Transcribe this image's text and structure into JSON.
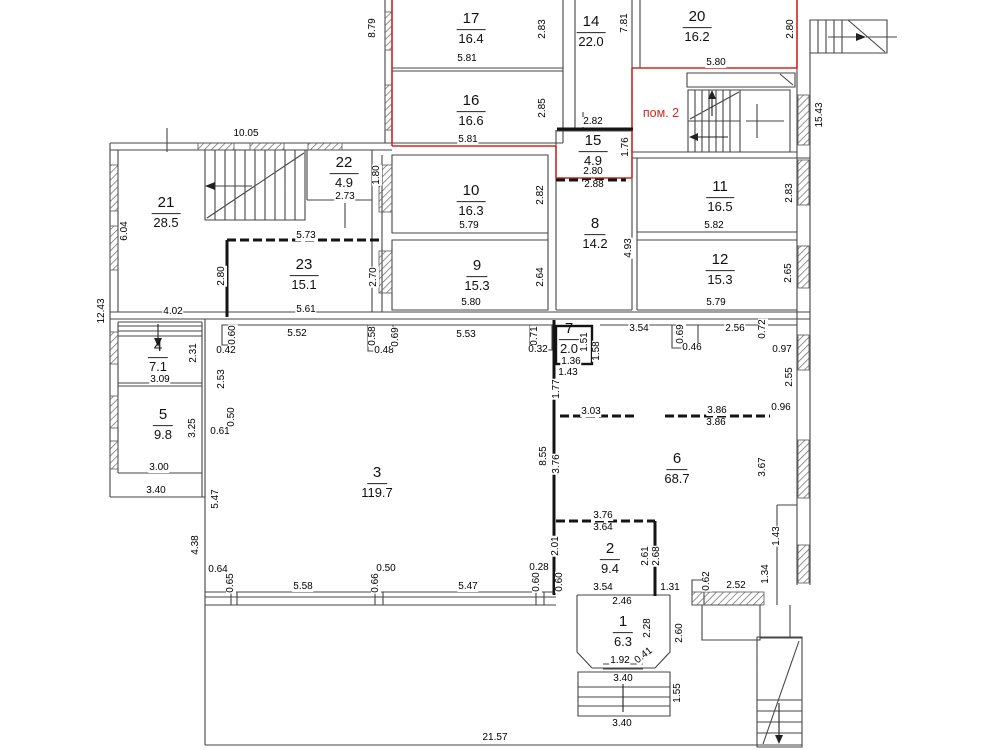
{
  "plan": {
    "unit_label": "пом. 2",
    "unit_label_color": "#d2281e",
    "unit_label_pos": {
      "x": 661,
      "y": 113
    },
    "wall_color": "#3f3f3f",
    "partition_color": "#141414",
    "background": "#ffffff"
  },
  "rooms": [
    {
      "number": "17",
      "area": "16.4",
      "x": 471,
      "y": 29
    },
    {
      "number": "16",
      "area": "16.6",
      "x": 471,
      "y": 111
    },
    {
      "number": "14",
      "area": "22.0",
      "x": 591,
      "y": 32
    },
    {
      "number": "20",
      "area": "16.2",
      "x": 697,
      "y": 27
    },
    {
      "number": "15",
      "area": "4.9",
      "x": 593,
      "y": 151
    },
    {
      "number": "21",
      "area": "28.5",
      "x": 166,
      "y": 213
    },
    {
      "number": "22",
      "area": "4.9",
      "x": 344,
      "y": 173
    },
    {
      "number": "23",
      "area": "15.1",
      "x": 304,
      "y": 275
    },
    {
      "number": "10",
      "area": "16.3",
      "x": 471,
      "y": 201
    },
    {
      "number": "9",
      "area": "15.3",
      "x": 477,
      "y": 276
    },
    {
      "number": "8",
      "area": "14.2",
      "x": 595,
      "y": 234
    },
    {
      "number": "11",
      "area": "16.5",
      "x": 720,
      "y": 197
    },
    {
      "number": "12",
      "area": "15.3",
      "x": 720,
      "y": 270
    },
    {
      "number": "4",
      "area": "7.1",
      "x": 158,
      "y": 357
    },
    {
      "number": "5",
      "area": "9.8",
      "x": 163,
      "y": 425
    },
    {
      "number": "3",
      "area": "119.7",
      "x": 377,
      "y": 483
    },
    {
      "number": "7",
      "area": "2.0",
      "x": 569,
      "y": 339
    },
    {
      "number": "6",
      "area": "68.7",
      "x": 677,
      "y": 469
    },
    {
      "number": "2",
      "area": "9.4",
      "x": 610,
      "y": 559
    },
    {
      "number": "1",
      "area": "6.3",
      "x": 623,
      "y": 632
    }
  ],
  "dimensions": [
    {
      "t": "8.79",
      "x": 373,
      "y": 28,
      "o": "v"
    },
    {
      "t": "5.81",
      "x": 467,
      "y": 59,
      "o": "h"
    },
    {
      "t": "2.83",
      "x": 543,
      "y": 29,
      "o": "v"
    },
    {
      "t": "7.81",
      "x": 625,
      "y": 23,
      "o": "v"
    },
    {
      "t": "5.81",
      "x": 468,
      "y": 140,
      "o": "h"
    },
    {
      "t": "2.85",
      "x": 543,
      "y": 108,
      "o": "v"
    },
    {
      "t": "2.82",
      "x": 593,
      "y": 122,
      "o": "h"
    },
    {
      "t": "1.76",
      "x": 626,
      "y": 147,
      "o": "v"
    },
    {
      "t": "2.80",
      "x": 593,
      "y": 172,
      "o": "h"
    },
    {
      "t": "2.88",
      "x": 594,
      "y": 185,
      "o": "h"
    },
    {
      "t": "5.80",
      "x": 716,
      "y": 63,
      "o": "h"
    },
    {
      "t": "2.80",
      "x": 791,
      "y": 29,
      "o": "v"
    },
    {
      "t": "15.43",
      "x": 820,
      "y": 115,
      "o": "v"
    },
    {
      "t": "10.05",
      "x": 246,
      "y": 134,
      "o": "h"
    },
    {
      "t": "6.04",
      "x": 125,
      "y": 231,
      "o": "v"
    },
    {
      "t": "2.73",
      "x": 345,
      "y": 197,
      "o": "h"
    },
    {
      "t": "1.80",
      "x": 377,
      "y": 175,
      "o": "v"
    },
    {
      "t": "5.73",
      "x": 306,
      "y": 236,
      "o": "h"
    },
    {
      "t": "2.80",
      "x": 222,
      "y": 276,
      "o": "v"
    },
    {
      "t": "2.70",
      "x": 374,
      "y": 277,
      "o": "v"
    },
    {
      "t": "5.61",
      "x": 306,
      "y": 310,
      "o": "h"
    },
    {
      "t": "4.02",
      "x": 173,
      "y": 312,
      "o": "h"
    },
    {
      "t": "12.43",
      "x": 102,
      "y": 311,
      "o": "v"
    },
    {
      "t": "5.79",
      "x": 469,
      "y": 226,
      "o": "h"
    },
    {
      "t": "2.82",
      "x": 541,
      "y": 195,
      "o": "v"
    },
    {
      "t": "5.80",
      "x": 471,
      "y": 303,
      "o": "h"
    },
    {
      "t": "2.64",
      "x": 541,
      "y": 277,
      "o": "v"
    },
    {
      "t": "4.93",
      "x": 629,
      "y": 248,
      "o": "v"
    },
    {
      "t": "5.82",
      "x": 714,
      "y": 226,
      "o": "h"
    },
    {
      "t": "2.83",
      "x": 790,
      "y": 193,
      "o": "v"
    },
    {
      "t": "5.79",
      "x": 716,
      "y": 303,
      "o": "h"
    },
    {
      "t": "2.65",
      "x": 789,
      "y": 273,
      "o": "v"
    },
    {
      "t": "3.09",
      "x": 160,
      "y": 380,
      "o": "h"
    },
    {
      "t": "2.31",
      "x": 194,
      "y": 353,
      "o": "v"
    },
    {
      "t": "3.00",
      "x": 159,
      "y": 468,
      "o": "h"
    },
    {
      "t": "3.25",
      "x": 193,
      "y": 428,
      "o": "v"
    },
    {
      "t": "0.60",
      "x": 233,
      "y": 335,
      "o": "v"
    },
    {
      "t": "0.42",
      "x": 226,
      "y": 351,
      "o": "h"
    },
    {
      "t": "2.53",
      "x": 222,
      "y": 379,
      "o": "v"
    },
    {
      "t": "0.50",
      "x": 232,
      "y": 417,
      "o": "v"
    },
    {
      "t": "0.61",
      "x": 220,
      "y": 432,
      "o": "h"
    },
    {
      "t": "3.40",
      "x": 156,
      "y": 491,
      "o": "h"
    },
    {
      "t": "5.52",
      "x": 297,
      "y": 334,
      "o": "h"
    },
    {
      "t": "0.58",
      "x": 373,
      "y": 336,
      "o": "v"
    },
    {
      "t": "0.48",
      "x": 384,
      "y": 351,
      "o": "h"
    },
    {
      "t": "0.69",
      "x": 396,
      "y": 337,
      "o": "v"
    },
    {
      "t": "5.53",
      "x": 466,
      "y": 335,
      "o": "h"
    },
    {
      "t": "0.71",
      "x": 535,
      "y": 336,
      "o": "v"
    },
    {
      "t": "0.32",
      "x": 538,
      "y": 350,
      "o": "h"
    },
    {
      "t": "1.51",
      "x": 585,
      "y": 342,
      "o": "v"
    },
    {
      "t": "1.58",
      "x": 597,
      "y": 351,
      "o": "v"
    },
    {
      "t": "1.36",
      "x": 571,
      "y": 362,
      "o": "h"
    },
    {
      "t": "1.43",
      "x": 568,
      "y": 373,
      "o": "h"
    },
    {
      "t": "3.54",
      "x": 639,
      "y": 329,
      "o": "h"
    },
    {
      "t": "0.69",
      "x": 681,
      "y": 334,
      "o": "v"
    },
    {
      "t": "0.46",
      "x": 692,
      "y": 348,
      "o": "h"
    },
    {
      "t": "2.56",
      "x": 735,
      "y": 329,
      "o": "h"
    },
    {
      "t": "0.72",
      "x": 763,
      "y": 329,
      "o": "v"
    },
    {
      "t": "0.97",
      "x": 782,
      "y": 350,
      "o": "h"
    },
    {
      "t": "2.55",
      "x": 790,
      "y": 377,
      "o": "v"
    },
    {
      "t": "1.77",
      "x": 557,
      "y": 389,
      "o": "v"
    },
    {
      "t": "3.03",
      "x": 591,
      "y": 412,
      "o": "h"
    },
    {
      "t": "3.86",
      "x": 717,
      "y": 411,
      "o": "h"
    },
    {
      "t": "3.86",
      "x": 716,
      "y": 423,
      "o": "h"
    },
    {
      "t": "0.96",
      "x": 781,
      "y": 408,
      "o": "h"
    },
    {
      "t": "8.55",
      "x": 544,
      "y": 456,
      "o": "v"
    },
    {
      "t": "3.76",
      "x": 557,
      "y": 464,
      "o": "v"
    },
    {
      "t": "3.67",
      "x": 763,
      "y": 467,
      "o": "v"
    },
    {
      "t": "5.47",
      "x": 216,
      "y": 499,
      "o": "v"
    },
    {
      "t": "4.38",
      "x": 196,
      "y": 545,
      "o": "v"
    },
    {
      "t": "2.01",
      "x": 556,
      "y": 546,
      "o": "v"
    },
    {
      "t": "3.76",
      "x": 603,
      "y": 516,
      "o": "h"
    },
    {
      "t": "3.64",
      "x": 603,
      "y": 528,
      "o": "h"
    },
    {
      "t": "2.61",
      "x": 646,
      "y": 556,
      "o": "v"
    },
    {
      "t": "2.68",
      "x": 657,
      "y": 556,
      "o": "v"
    },
    {
      "t": "1.43",
      "x": 777,
      "y": 536,
      "o": "v"
    },
    {
      "t": "1.34",
      "x": 766,
      "y": 574,
      "o": "v"
    },
    {
      "t": "0.64",
      "x": 218,
      "y": 570,
      "o": "h"
    },
    {
      "t": "0.65",
      "x": 231,
      "y": 583,
      "o": "v"
    },
    {
      "t": "5.58",
      "x": 303,
      "y": 587,
      "o": "h"
    },
    {
      "t": "0.50",
      "x": 386,
      "y": 569,
      "o": "h"
    },
    {
      "t": "0.66",
      "x": 376,
      "y": 583,
      "o": "v"
    },
    {
      "t": "5.47",
      "x": 468,
      "y": 587,
      "o": "h"
    },
    {
      "t": "0.28",
      "x": 539,
      "y": 568,
      "o": "h"
    },
    {
      "t": "0.60",
      "x": 537,
      "y": 582,
      "o": "v"
    },
    {
      "t": "0.60",
      "x": 560,
      "y": 582,
      "o": "v"
    },
    {
      "t": "3.54",
      "x": 603,
      "y": 588,
      "o": "h"
    },
    {
      "t": "1.31",
      "x": 670,
      "y": 588,
      "o": "h"
    },
    {
      "t": "0.62",
      "x": 707,
      "y": 581,
      "o": "v"
    },
    {
      "t": "2.52",
      "x": 736,
      "y": 586,
      "o": "h"
    },
    {
      "t": "2.46",
      "x": 622,
      "y": 602,
      "o": "h"
    },
    {
      "t": "2.28",
      "x": 648,
      "y": 628,
      "o": "v"
    },
    {
      "t": "2.60",
      "x": 680,
      "y": 633,
      "o": "v"
    },
    {
      "t": "1.92",
      "x": 620,
      "y": 661,
      "o": "h"
    },
    {
      "t": "0.41",
      "x": 644,
      "y": 656,
      "o": "d"
    },
    {
      "t": "3.40",
      "x": 623,
      "y": 679,
      "o": "h"
    },
    {
      "t": "1.55",
      "x": 678,
      "y": 693,
      "o": "v"
    },
    {
      "t": "3.40",
      "x": 622,
      "y": 724,
      "o": "h"
    },
    {
      "t": "21.57",
      "x": 495,
      "y": 738,
      "o": "h"
    }
  ]
}
